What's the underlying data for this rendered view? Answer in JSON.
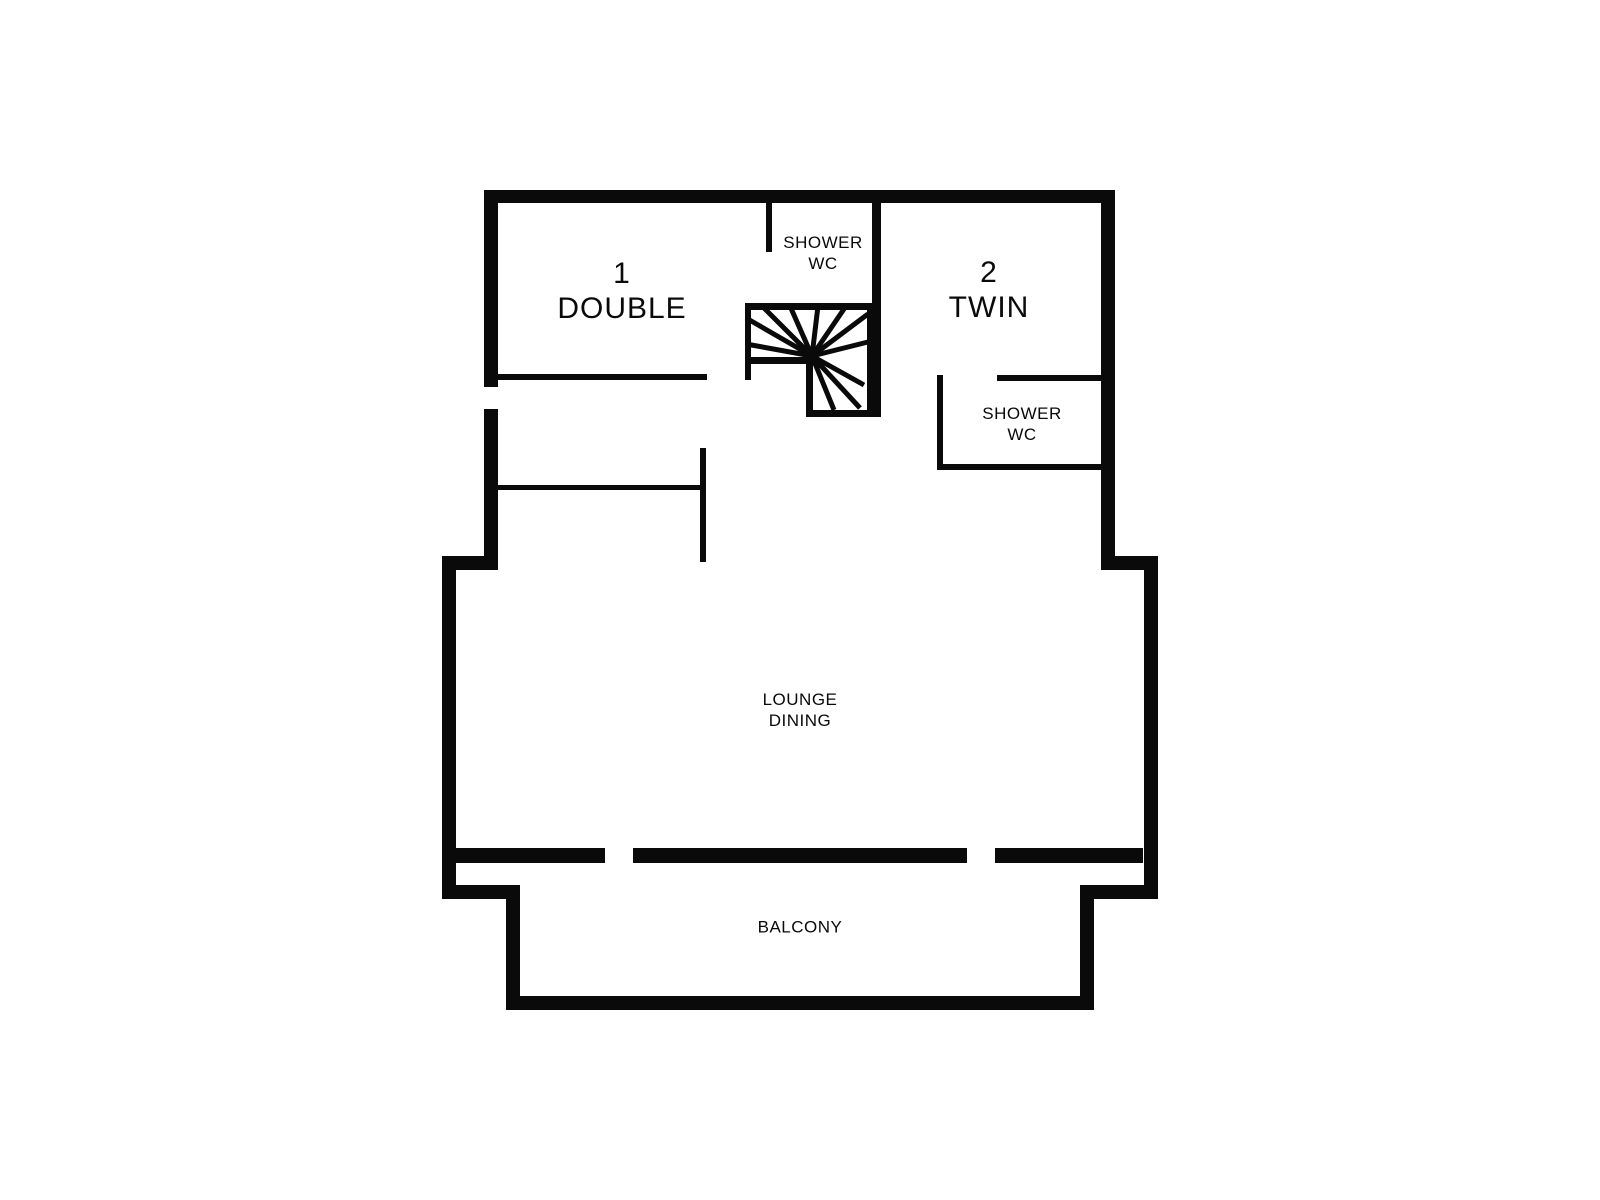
{
  "page": {
    "background_color": "#ffffff",
    "wall_color": "#0a0a0a"
  },
  "rooms": {
    "double": {
      "number": "1",
      "name": "DOUBLE"
    },
    "twin": {
      "number": "2",
      "name": "TWIN"
    },
    "shower_top": {
      "line1": "SHOWER",
      "line2": "WC"
    },
    "shower_right": {
      "line1": "SHOWER",
      "line2": "WC"
    },
    "lounge": {
      "line1": "LOUNGE",
      "line2": "DINING"
    },
    "balcony": {
      "name": "BALCONY"
    }
  },
  "floorplan": {
    "wall_color": "#0a0a0a",
    "walls": [
      [
        484,
        190,
        631,
        13
      ],
      [
        484,
        190,
        14,
        197
      ],
      [
        484,
        409,
        14,
        161
      ],
      [
        1101,
        190,
        14,
        380
      ],
      [
        442,
        556,
        56,
        14
      ],
      [
        1101,
        556,
        57,
        14
      ],
      [
        442,
        556,
        14,
        343
      ],
      [
        1144,
        556,
        14,
        343
      ],
      [
        456,
        848,
        149,
        15
      ],
      [
        633,
        848,
        334,
        15
      ],
      [
        995,
        848,
        148,
        15
      ],
      [
        442,
        885,
        78,
        14
      ],
      [
        1080,
        885,
        78,
        14
      ],
      [
        506,
        885,
        14,
        125
      ],
      [
        1080,
        885,
        14,
        125
      ],
      [
        506,
        996,
        588,
        14
      ],
      [
        498,
        374,
        209,
        6
      ],
      [
        766,
        203,
        6,
        49
      ],
      [
        872,
        203,
        9,
        107
      ],
      [
        937,
        375,
        6,
        95
      ],
      [
        997,
        375,
        104,
        6
      ],
      [
        937,
        464,
        164,
        6
      ],
      [
        498,
        485,
        205,
        5
      ],
      [
        700,
        448,
        6,
        114
      ],
      [
        745,
        303,
        136,
        7
      ],
      [
        745,
        303,
        6,
        77
      ],
      [
        745,
        357,
        67,
        7
      ],
      [
        806,
        357,
        7,
        60
      ],
      [
        806,
        410,
        75,
        7
      ],
      [
        867,
        303,
        14,
        114
      ]
    ],
    "stair": {
      "center": [
        812,
        356
      ],
      "spoke_width": 5,
      "spokes": [
        [
          746,
          344
        ],
        [
          746,
          318
        ],
        [
          762,
          306
        ],
        [
          790,
          306
        ],
        [
          818,
          306
        ],
        [
          846,
          306
        ],
        [
          868,
          314
        ],
        [
          868,
          342
        ],
        [
          864,
          385
        ],
        [
          860,
          408
        ],
        [
          834,
          410
        ]
      ]
    }
  }
}
